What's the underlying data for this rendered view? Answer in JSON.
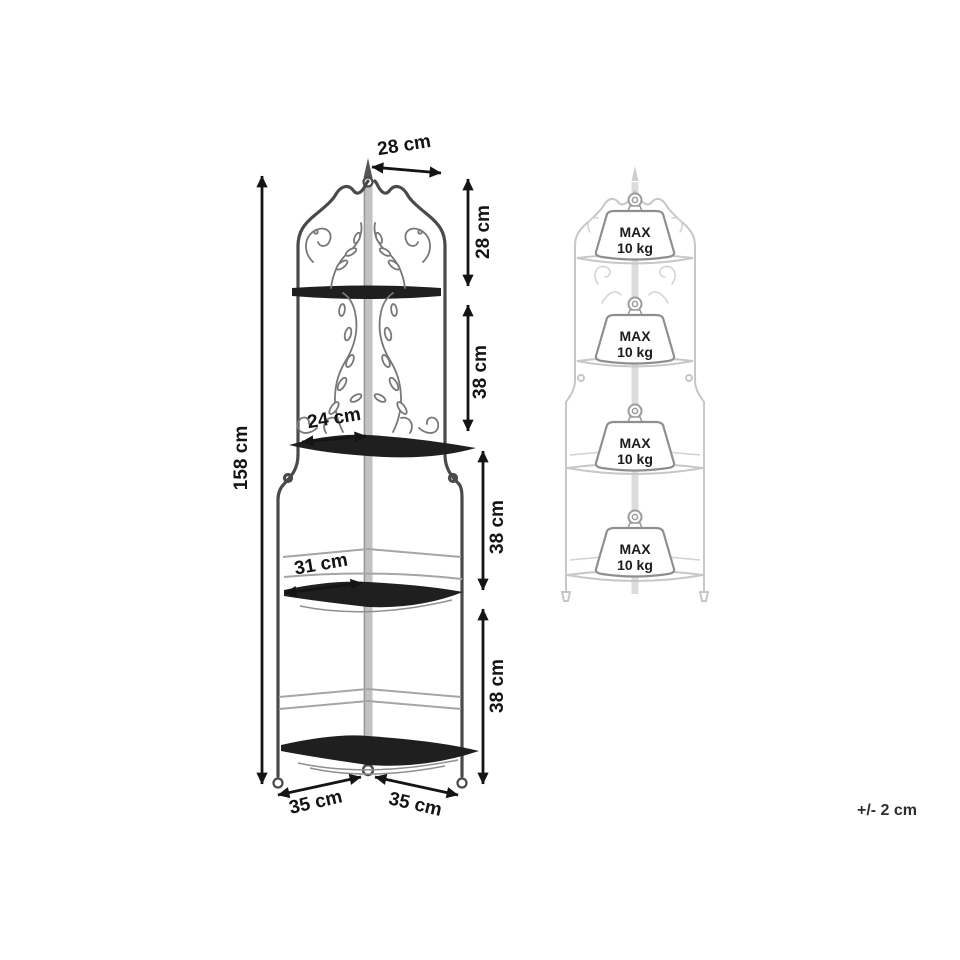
{
  "sheet": {
    "tolerance_note": "+/- 2 cm"
  },
  "dimensions": {
    "total_height": "158 cm",
    "top_width": "28 cm",
    "top_section_height": "28 cm",
    "upper_section_height": "38 cm",
    "middle_section_height": "38 cm",
    "bottom_section_height": "38 cm",
    "shelf2_depth": "24 cm",
    "shelf3_depth": "31 cm",
    "base_left_width": "35 cm",
    "base_right_width": "35 cm"
  },
  "load_diagram": {
    "max_load_line1": "MAX",
    "max_load_line2": "10 kg",
    "shelf_count": 4
  },
  "colors": {
    "background": "#ffffff",
    "drawing_line": "#4a4a4a",
    "dimension_line": "#141414",
    "shelf_fill": "#1f1f1f",
    "pole_fill": "#c2c2c2",
    "ghost_line": "#c7c7c7",
    "label_text": "#141414"
  }
}
